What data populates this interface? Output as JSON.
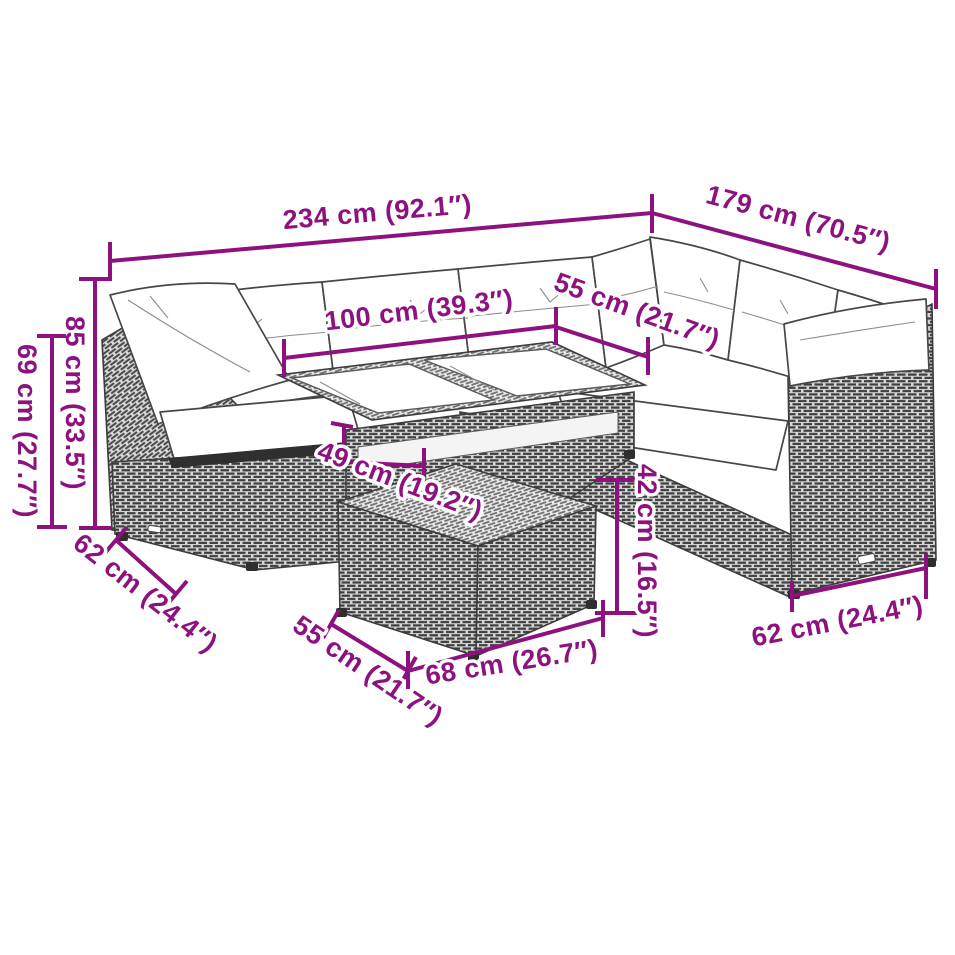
{
  "page": {
    "background_color": "#ffffff",
    "accent_color": "#8D1280",
    "artwork": "poly rattan corner sofa set with glass-top table and footstool — dimension line drawing"
  },
  "scene": {
    "parts": [
      "corner-sofa",
      "back-cushions",
      "arm-pillows",
      "seat-cushions",
      "glass-top-table",
      "footstool"
    ]
  },
  "dimensions": {
    "sofa_total_width": "234 cm (92.1″)",
    "sofa_total_depth_right": "179 cm (70.5″)",
    "table_length": "100 cm (39.3″)",
    "table_depth": "55 cm (21.7″)",
    "back_height": "85 cm (33.5″)",
    "arm_height": "69 cm (27.7″)",
    "seat_depth_left": "62 cm (24.4″)",
    "table_height": "49 cm (19.2″)",
    "footstool_height": "42 cm (16.5″)",
    "footstool_depth": "55 cm (21.7″)",
    "footstool_width": "68 cm (26.7″)",
    "seat_depth_right": "62 cm (24.4″)"
  }
}
